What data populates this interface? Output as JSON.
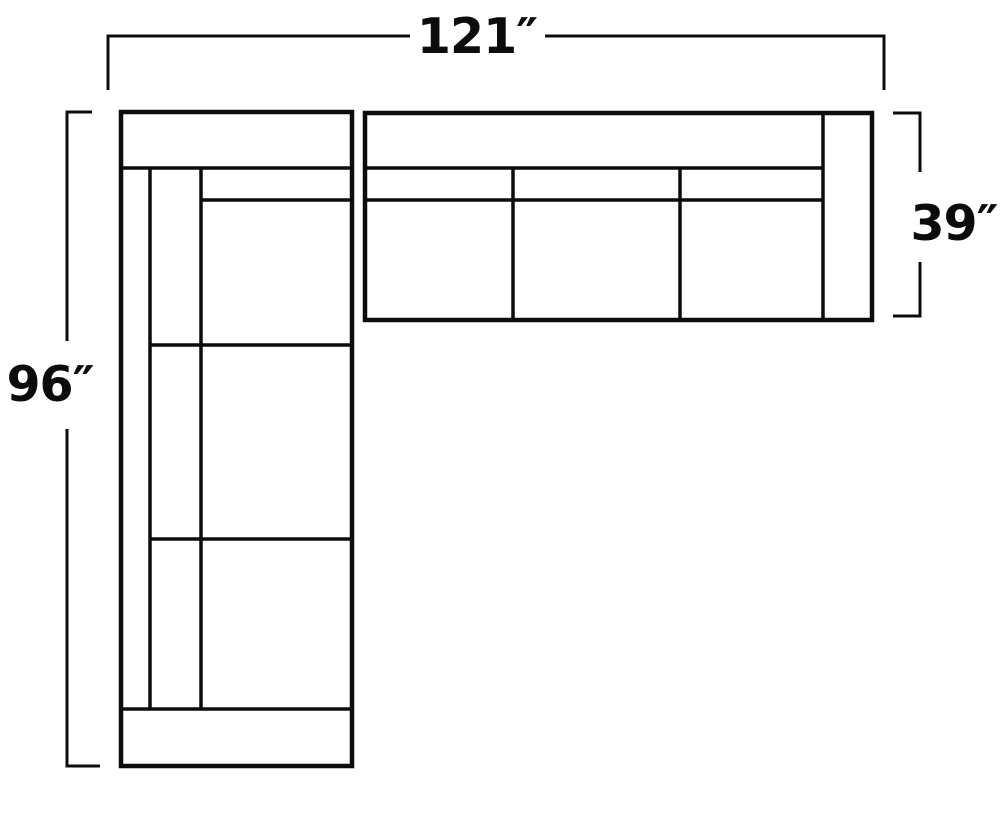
{
  "diagram": {
    "title": "sectional-sofa-dimension-floorplan",
    "view": "top-down",
    "line_color": "#0c0c0c",
    "background_color": "#ffffff",
    "labels": {
      "overall_width": "121″",
      "overall_depth": "96″",
      "sofa_depth": "39″"
    },
    "measurements": {
      "overall_width_inches": 121,
      "overall_depth_inches": 96,
      "sofa_depth_inches": 39
    }
  }
}
